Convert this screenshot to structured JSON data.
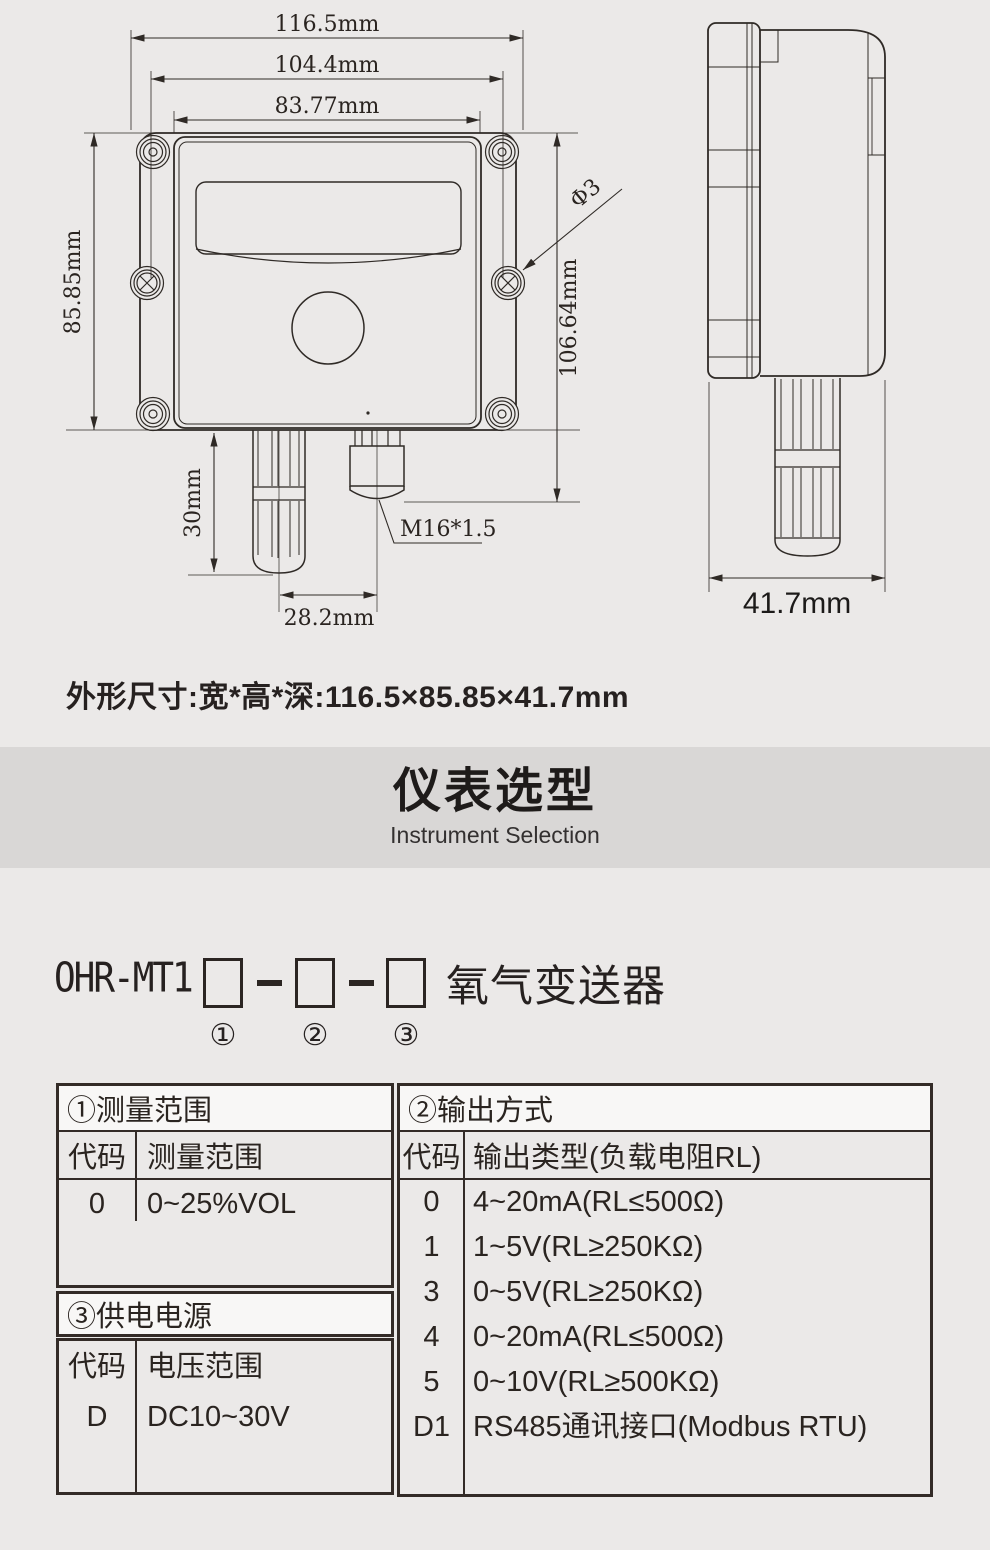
{
  "figure": {
    "dimensions": {
      "width_total": "116.5mm",
      "mount_hole_spacing": "104.4mm",
      "width_inner": "83.77mm",
      "height_body": "85.85mm",
      "height_with_gland": "106.64mm",
      "probe_length": "30mm",
      "probe_offset": "28.2mm",
      "hole_diameter": "Φ3",
      "thread_spec": "M16*1.5",
      "depth": "41.7mm"
    }
  },
  "size_note": "外形尺寸:宽*高*深:116.5×85.85×41.7mm",
  "banner": {
    "title": "仪表选型",
    "subtitle": "Instrument Selection"
  },
  "model": {
    "prefix": "OHR-MT1",
    "product": "氧气变送器",
    "slot_marks": [
      "①",
      "②",
      "③"
    ]
  },
  "selection_table": {
    "range": {
      "title": "①测量范围",
      "col_code": "代码",
      "col_value": "测量范围",
      "rows": [
        {
          "code": "0",
          "value": "0~25%VOL"
        }
      ]
    },
    "power": {
      "title": "③供电电源",
      "col_code": "代码",
      "col_value": "电压范围",
      "rows": [
        {
          "code": "D",
          "value": "DC10~30V"
        }
      ]
    },
    "output": {
      "title": "②输出方式",
      "col_code": "代码",
      "col_value": "输出类型(负载电阻RL)",
      "rows": [
        {
          "code": "0",
          "value": "4~20mA(RL≤500Ω)"
        },
        {
          "code": "1",
          "value": "1~5V(RL≥250KΩ)"
        },
        {
          "code": "3",
          "value": "0~5V(RL≥250KΩ)"
        },
        {
          "code": "4",
          "value": "0~20mA(RL≤500Ω)"
        },
        {
          "code": "5",
          "value": "0~10V(RL≥500KΩ)"
        },
        {
          "code": "D1",
          "value": "RS485通讯接口(Modbus RTU)"
        }
      ]
    }
  },
  "colors": {
    "page_bg": "#ebe9e8",
    "banner_bg": "#d9d7d6",
    "header_strip_bg": "#f8f7f6",
    "line_dark": "#332b27",
    "text": "#272220"
  }
}
